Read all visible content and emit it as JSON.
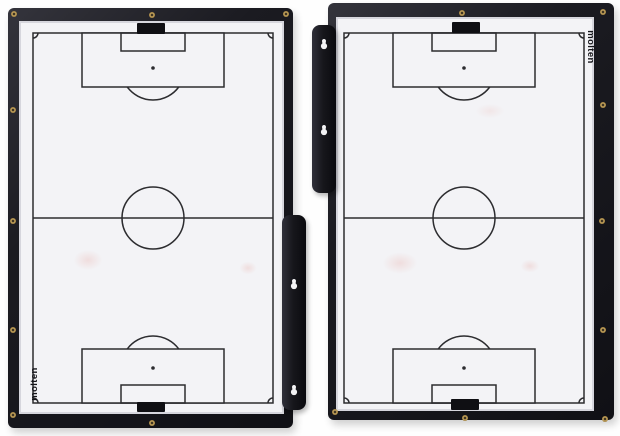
{
  "scene": {
    "description": "Product photo of a two-panel folding soccer coaching tactics board, shown open with both whiteboard panels facing forward",
    "background_color": "#fefefe"
  },
  "colors": {
    "frame": "#16161b",
    "surface": "#f3f3f6",
    "pitch_line": "#2c2c2f",
    "clip": "#0f0f13",
    "screw_brass": "#caa85e",
    "smudge": "#e07a6e"
  },
  "boards": [
    {
      "id": "left-board",
      "brand_label": "molten",
      "logo_position": "bottom-left-vertical",
      "hinge_bracket": {
        "side": "right",
        "keyhole_count": 2
      },
      "clips": [
        "top-center",
        "bottom-center"
      ],
      "visible_screw_count": 8
    },
    {
      "id": "right-board",
      "brand_label": "molten",
      "logo_position": "top-right-vertical",
      "hinge_bracket": {
        "side": "left",
        "keyhole_count": 2
      },
      "clips": [
        "top-center",
        "bottom-center"
      ],
      "visible_screw_count": 8
    }
  ],
  "pitch_markings": [
    "outer-boundary",
    "halfway-line",
    "center-circle",
    "penalty-area-top",
    "penalty-area-bottom",
    "goal-area-top",
    "goal-area-bottom",
    "penalty-spot-top",
    "penalty-spot-bottom",
    "penalty-arc-top",
    "penalty-arc-bottom",
    "corner-arcs"
  ]
}
